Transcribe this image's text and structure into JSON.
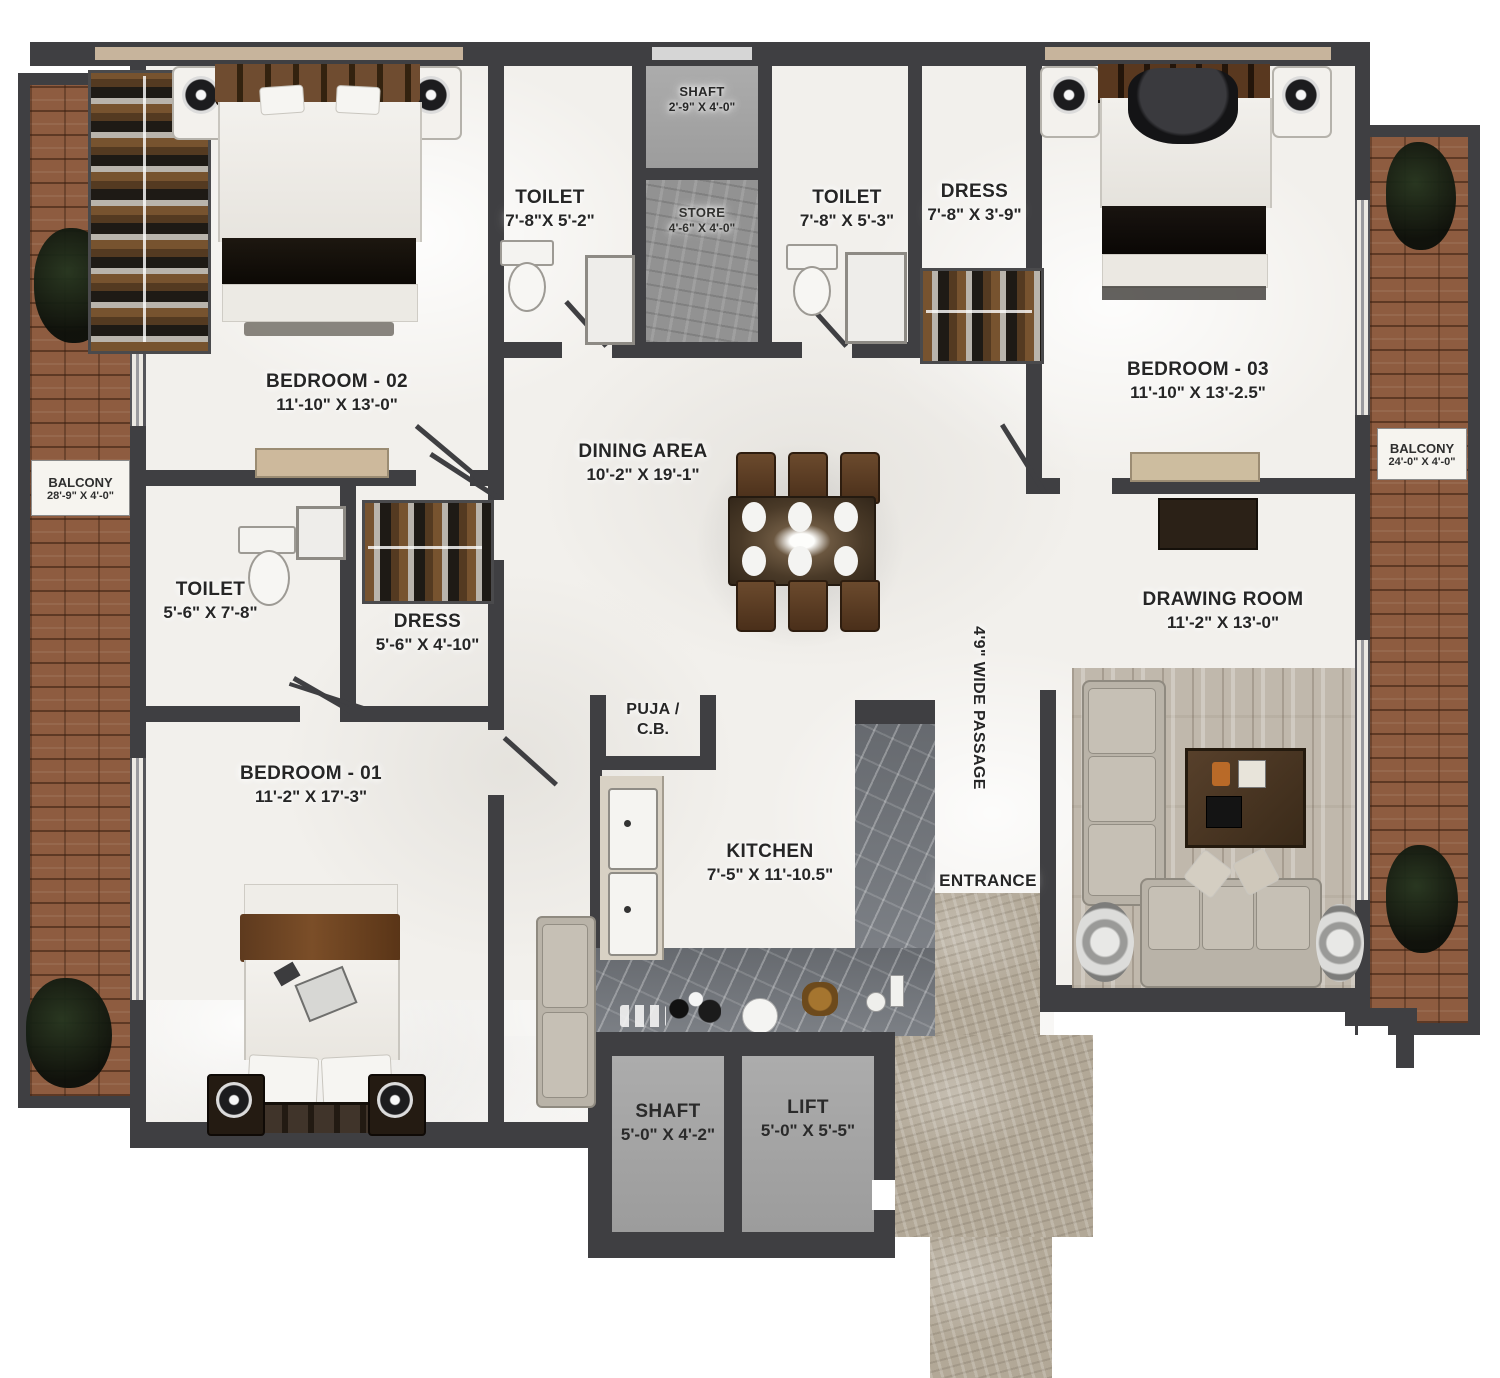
{
  "title": "3BHK Apartment Floor Plan",
  "labels": {
    "shaft_top": {
      "line1": "SHAFT",
      "line2": "2'-9\" X 4'-0\""
    },
    "toilet_top_left": {
      "line1": "TOILET",
      "line2": "7'-8\"X 5'-2\""
    },
    "store": {
      "line1": "STORE",
      "line2": "4'-6\" X 4'-0\""
    },
    "toilet_top_right": {
      "line1": "TOILET",
      "line2": "7'-8\" X 5'-3\""
    },
    "dress_top_right": {
      "line1": "DRESS",
      "line2": "7'-8\" X 3'-9\""
    },
    "bedroom_02": {
      "line1": "BEDROOM - 02",
      "line2": "11'-10\" X 13'-0\""
    },
    "bedroom_03": {
      "line1": "BEDROOM - 03",
      "line2": "11'-10\" X 13'-2.5\""
    },
    "balcony_left": {
      "line1": "BALCONY",
      "line2": "28'-9\" X 4'-0\""
    },
    "balcony_right": {
      "line1": "BALCONY",
      "line2": "24'-0\" X 4'-0\""
    },
    "dining_area": {
      "line1": "DINING AREA",
      "line2": "10'-2\" X 19'-1\""
    },
    "toilet_mid_left": {
      "line1": "TOILET",
      "line2": "5'-6\" X 7'-8\""
    },
    "dress_mid_left": {
      "line1": "DRESS",
      "line2": "5'-6\" X 4'-10\""
    },
    "drawing_room": {
      "line1": "DRAWING ROOM",
      "line2": "11'-2\" X 13'-0\""
    },
    "passage": {
      "line1": "4'9\" WIDE PASSAGE"
    },
    "bedroom_01": {
      "line1": "BEDROOM - 01",
      "line2": "11'-2\" X 17'-3\""
    },
    "puja": {
      "line1": "PUJA /",
      "line2": "C.B."
    },
    "kitchen": {
      "line1": "KITCHEN",
      "line2": "7'-5\" X 11'-10.5\""
    },
    "entrance": {
      "line1": "ENTRANCE"
    },
    "shaft_bottom": {
      "line1": "SHAFT",
      "line2": "5'-0\" X 4'-2\""
    },
    "lift": {
      "line1": "LIFT",
      "line2": "5'-0\" X 5'-5\""
    }
  },
  "colors": {
    "wall": "#3f3f42",
    "floor_marble": "#f2f0ec",
    "balcony_brick": "#8e5c40",
    "shaft_lift_fill": "#a4a4a4",
    "kitchen_counter_marble": "#74787e",
    "entrance_walkway_stone": "#b2a897",
    "drawing_room_wood": "#c0b8ac",
    "furniture_dark_brown": "#3a2b1c",
    "label_text": "#262626"
  }
}
